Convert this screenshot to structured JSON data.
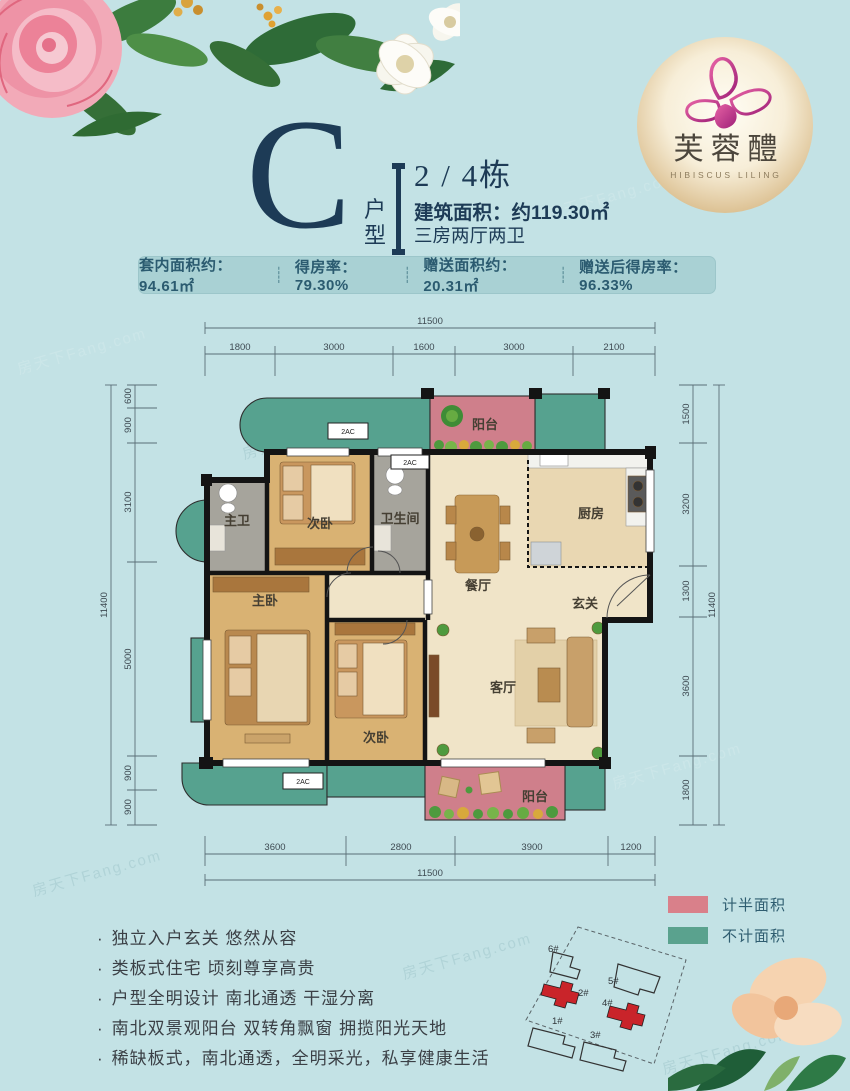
{
  "colors": {
    "background": "#c3e2e5",
    "navy": "#1d3b56",
    "stats_bg": "#a9d1d4",
    "balcony_pink": "#cf7f8b",
    "bay_teal": "#56a28f"
  },
  "logo": {
    "name_cn": "芙蓉醴",
    "name_en": "HIBISCUS LILING"
  },
  "header": {
    "unit_letter": "C",
    "unit_label": "户型",
    "building": "2 / 4栋",
    "area_line": "建筑面积：约119.30㎡",
    "layout_line": "三房两厅两卫"
  },
  "stats": {
    "divider": "┊",
    "items": [
      "套内面积约：94.61㎡",
      "得房率：79.30%",
      "赠送面积约：20.31㎡",
      "赠送后得房率：96.33%"
    ]
  },
  "plan": {
    "window_label": "2AC",
    "rooms": {
      "balcony_top": "阳台",
      "bedroom2_top": "次卧",
      "master_bath": "主卫",
      "bathroom": "卫生间",
      "dining": "餐厅",
      "kitchen": "厨房",
      "foyer": "玄关",
      "master_bedroom": "主卧",
      "bedroom2_bottom": "次卧",
      "living": "客厅",
      "balcony_bottom": "阳台"
    },
    "dims": {
      "top_total": "11500",
      "top_segments": [
        "1800",
        "3000",
        "1600",
        "3000",
        "2100"
      ],
      "bottom_segments": [
        "3600",
        "2800",
        "3900",
        "1200"
      ],
      "bottom_total": "11500",
      "left_total": "11400",
      "left_segments": [
        "600",
        "900",
        "3100",
        "5000",
        "900",
        "900"
      ],
      "right_total": "11400",
      "right_segments": [
        "1500",
        "3200",
        "1300",
        "3600",
        "1800"
      ]
    }
  },
  "legend": {
    "items": [
      {
        "label": "计半面积",
        "color": "#d9808a"
      },
      {
        "label": "不计面积",
        "color": "#5aa28e"
      }
    ]
  },
  "siteplan": {
    "buildings": [
      "1#",
      "2#",
      "3#",
      "4#",
      "5#",
      "6#"
    ]
  },
  "features": {
    "bullet": "·",
    "items": [
      "独立入户玄关 悠然从容",
      "类板式住宅 顷刻尊享高贵",
      "户型全明设计 南北通透 干湿分离",
      "南北双景观阳台 双转角飘窗 拥揽阳光天地",
      "稀缺板式，南北通透，全明采光，私享健康生活"
    ]
  },
  "watermark": {
    "text": "房天下Fang.com"
  }
}
